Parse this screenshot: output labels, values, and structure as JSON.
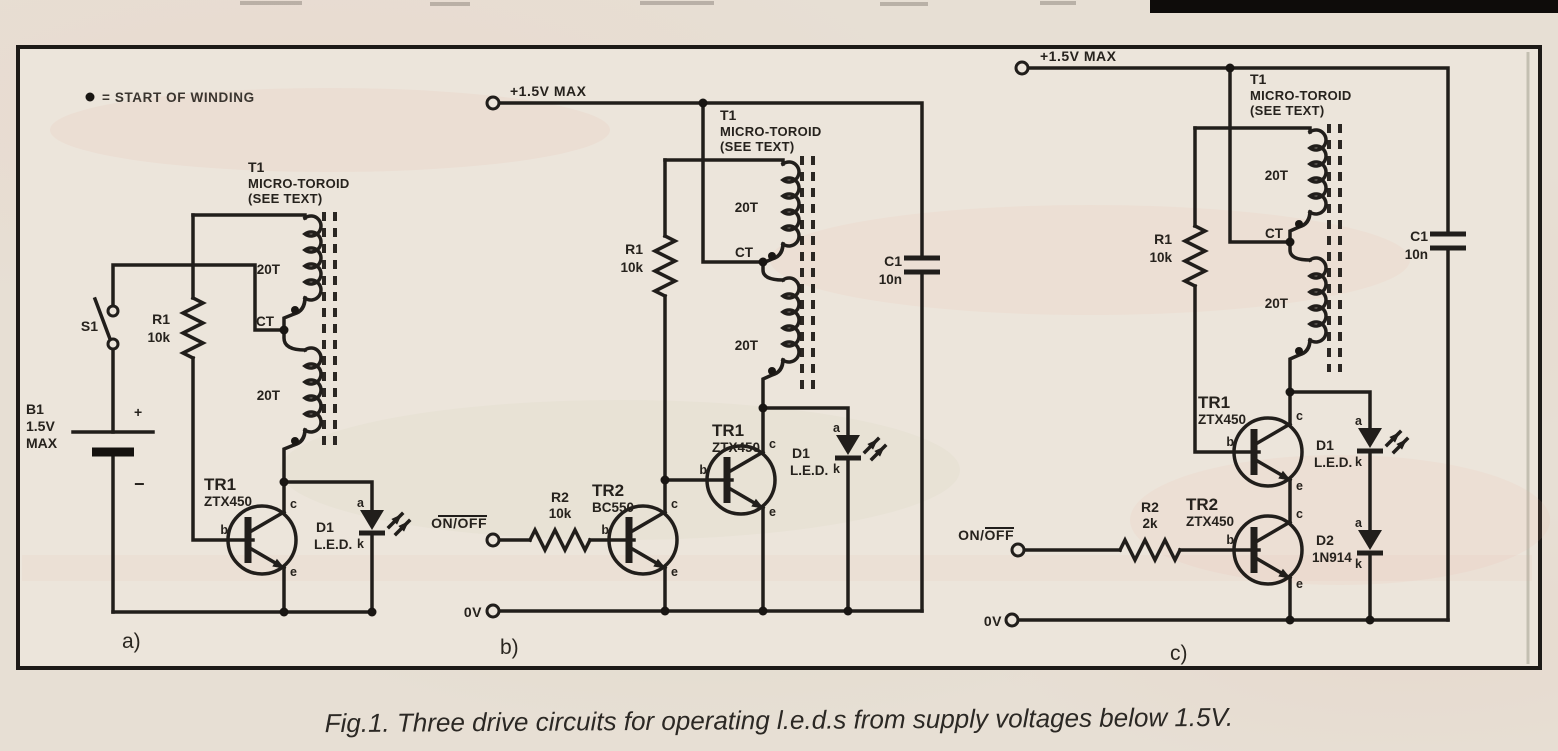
{
  "page": {
    "legend_bullet": "●",
    "legend_text": "= START OF WINDING",
    "caption": "Fig.1. Three drive circuits for operating l.e.d.s from supply voltages below 1.5V."
  },
  "circuit_a": {
    "label": "a)",
    "s1": "S1",
    "b1_ref": "B1",
    "b1_value": "1.5V",
    "b1_max": "MAX",
    "plus": "+",
    "minus": "−",
    "r1_ref": "R1",
    "r1_value": "10k",
    "t1_ref": "T1",
    "t1_name": "MICRO-TOROID",
    "t1_note": "(SEE TEXT)",
    "turns_top": "20T",
    "turns_bottom": "20T",
    "tap": "CT",
    "tr1_ref": "TR1",
    "tr1_part": "ZTX450",
    "d1_ref": "D1",
    "d1_part": "L.E.D.",
    "pin_b": "b",
    "pin_c": "c",
    "pin_e": "e",
    "pin_a": "a",
    "pin_k": "k"
  },
  "circuit_b": {
    "label": "b)",
    "supply": "+1.5V MAX",
    "gnd": "0V",
    "onoff": "ON/OFF",
    "r1_ref": "R1",
    "r1_value": "10k",
    "r2_ref": "R2",
    "r2_value": "10k",
    "t1_ref": "T1",
    "t1_name": "MICRO-TOROID",
    "t1_note": "(SEE TEXT)",
    "turns_top": "20T",
    "turns_bottom": "20T",
    "tap": "CT",
    "tr1_ref": "TR1",
    "tr1_part": "ZTX450",
    "tr2_ref": "TR2",
    "tr2_part": "BC550",
    "c1_ref": "C1",
    "c1_value": "10n",
    "d1_ref": "D1",
    "d1_part": "L.E.D.",
    "pin_b": "b",
    "pin_c": "c",
    "pin_e": "e",
    "pin_a": "a",
    "pin_k": "k"
  },
  "circuit_c": {
    "label": "c)",
    "supply": "+1.5V MAX",
    "gnd": "0V",
    "onoff": "ON/OFF",
    "r1_ref": "R1",
    "r1_value": "10k",
    "r2_ref": "R2",
    "r2_value": "2k",
    "t1_ref": "T1",
    "t1_name": "MICRO-TOROID",
    "t1_note": "(SEE TEXT)",
    "turns_top": "20T",
    "turns_bottom": "20T",
    "tap": "CT",
    "tr1_ref": "TR1",
    "tr1_part": "ZTX450",
    "tr2_ref": "TR2",
    "tr2_part": "ZTX450",
    "c1_ref": "C1",
    "c1_value": "10n",
    "d1_ref": "D1",
    "d1_part": "L.E.D.",
    "d2_ref": "D2",
    "d2_part": "1N914",
    "pin_b": "b",
    "pin_c": "c",
    "pin_e": "e",
    "pin_a": "a",
    "pin_k": "k"
  }
}
